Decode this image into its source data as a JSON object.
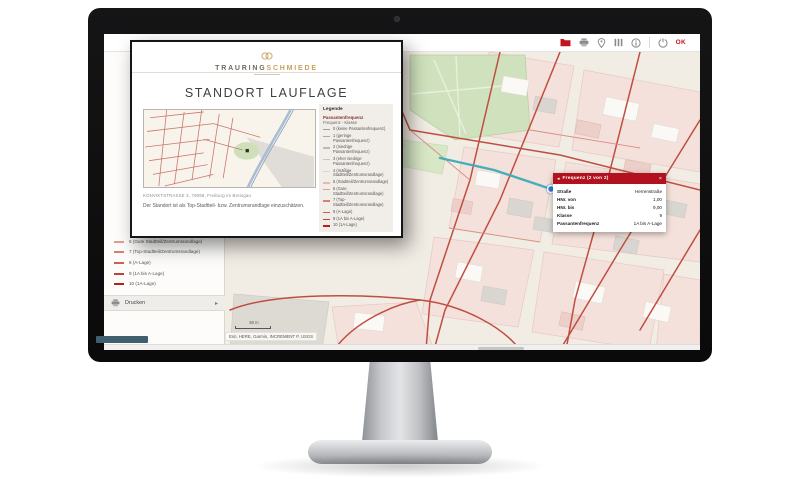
{
  "app": {
    "toolbar": {
      "icons": [
        {
          "name": "folder-icon",
          "color": "#bf1722"
        },
        {
          "name": "print-icon",
          "color": "#8a8a8a"
        },
        {
          "name": "location-pin-icon",
          "color": "#8a8a8a"
        },
        {
          "name": "layers-icon",
          "color": "#8a8a8a"
        },
        {
          "name": "info-icon",
          "color": "#8a8a8a"
        },
        {
          "name": "power-icon",
          "color": "#8a8a8a"
        }
      ],
      "ok_label": "OK"
    }
  },
  "report_overlay": {
    "brand": {
      "name_left": "TRAURING",
      "name_right": "SCHMIEDE",
      "accent_color": "#c9a05a",
      "logo_icon": "wedding-rings-icon"
    },
    "title": "STANDORT LAUFLAGE",
    "map_caption": "KONVIKTSTRASSE 3, 79098, Freiburg im Breisgau",
    "description": "Der Standort ist als Top-Stadtteil- bzw. Zentrumsrandlage einzuschätzen.",
    "legend": {
      "title": "Legende",
      "group": "Passantenfrequenz",
      "subgroup": "Frequenz - Klasse",
      "items": [
        {
          "label": "0 (keine Passantenfrequenz)",
          "color": "#9aa0a6"
        },
        {
          "label": "1 (geringe Passantenfrequenz)",
          "color": "#a8adb2"
        },
        {
          "label": "2 (niedrige Passantenfrequenz)",
          "color": "#b6babd"
        },
        {
          "label": "3 (eher niedrige Passantenfrequenz)",
          "color": "#c4c7c9"
        },
        {
          "label": "4 (mäßige Stadtteil/Zentrumsrandlage)",
          "color": "#f0cdc6"
        },
        {
          "label": "5 (Stadtteil/Zentrumsrandlage)",
          "color": "#e9b7ae"
        },
        {
          "label": "6 (Gute Stadtteil/Zentrumsrandlage)",
          "color": "#e19d92"
        },
        {
          "label": "7 (Top-Stadtteil/Zentrumsrandlage)",
          "color": "#d77f72"
        },
        {
          "label": "8 (A-Lage)",
          "color": "#cc6052"
        },
        {
          "label": "9 (1A bis A-Lage)",
          "color": "#c04234"
        },
        {
          "label": "10 (1A-Lage)",
          "color": "#b02318"
        }
      ]
    }
  },
  "sidebar": {
    "items": [
      {
        "label": "6 (Gute Stadtteil/Zentrumsrandlage)",
        "color": "#e19d92"
      },
      {
        "label": "7 (Top-Stadtteil/Zentrumsrandlage)",
        "color": "#d77f72"
      },
      {
        "label": "8 (A-Lage)",
        "color": "#cc6052"
      },
      {
        "label": "9 (1A bis A-Lage)",
        "color": "#c04234"
      },
      {
        "label": "10 (1A-Lage)",
        "color": "#b02318"
      }
    ],
    "print_label": "Drucken",
    "chevron_icon": "▸"
  },
  "popup": {
    "title": "Frequenz (2 von 2)",
    "header_color": "#b1121d",
    "back_icon": "◂",
    "close_icon": "×",
    "rows": [
      {
        "label": "Straße",
        "value": "Herrenstraße"
      },
      {
        "label": "HNr. von",
        "value": "1,00"
      },
      {
        "label": "HNr. bis",
        "value": "9,00"
      },
      {
        "label": "Klasse",
        "value": "9"
      },
      {
        "label": "Passantenfrequenz",
        "value": "1A bis A-Lage"
      }
    ]
  },
  "map": {
    "attribution": "Esri, HERE, Garmin, INCREMENT P, USGS",
    "scale_label": "50 m",
    "highlight_color": "#3aacb8",
    "marker_color": "#2e7ed0"
  }
}
